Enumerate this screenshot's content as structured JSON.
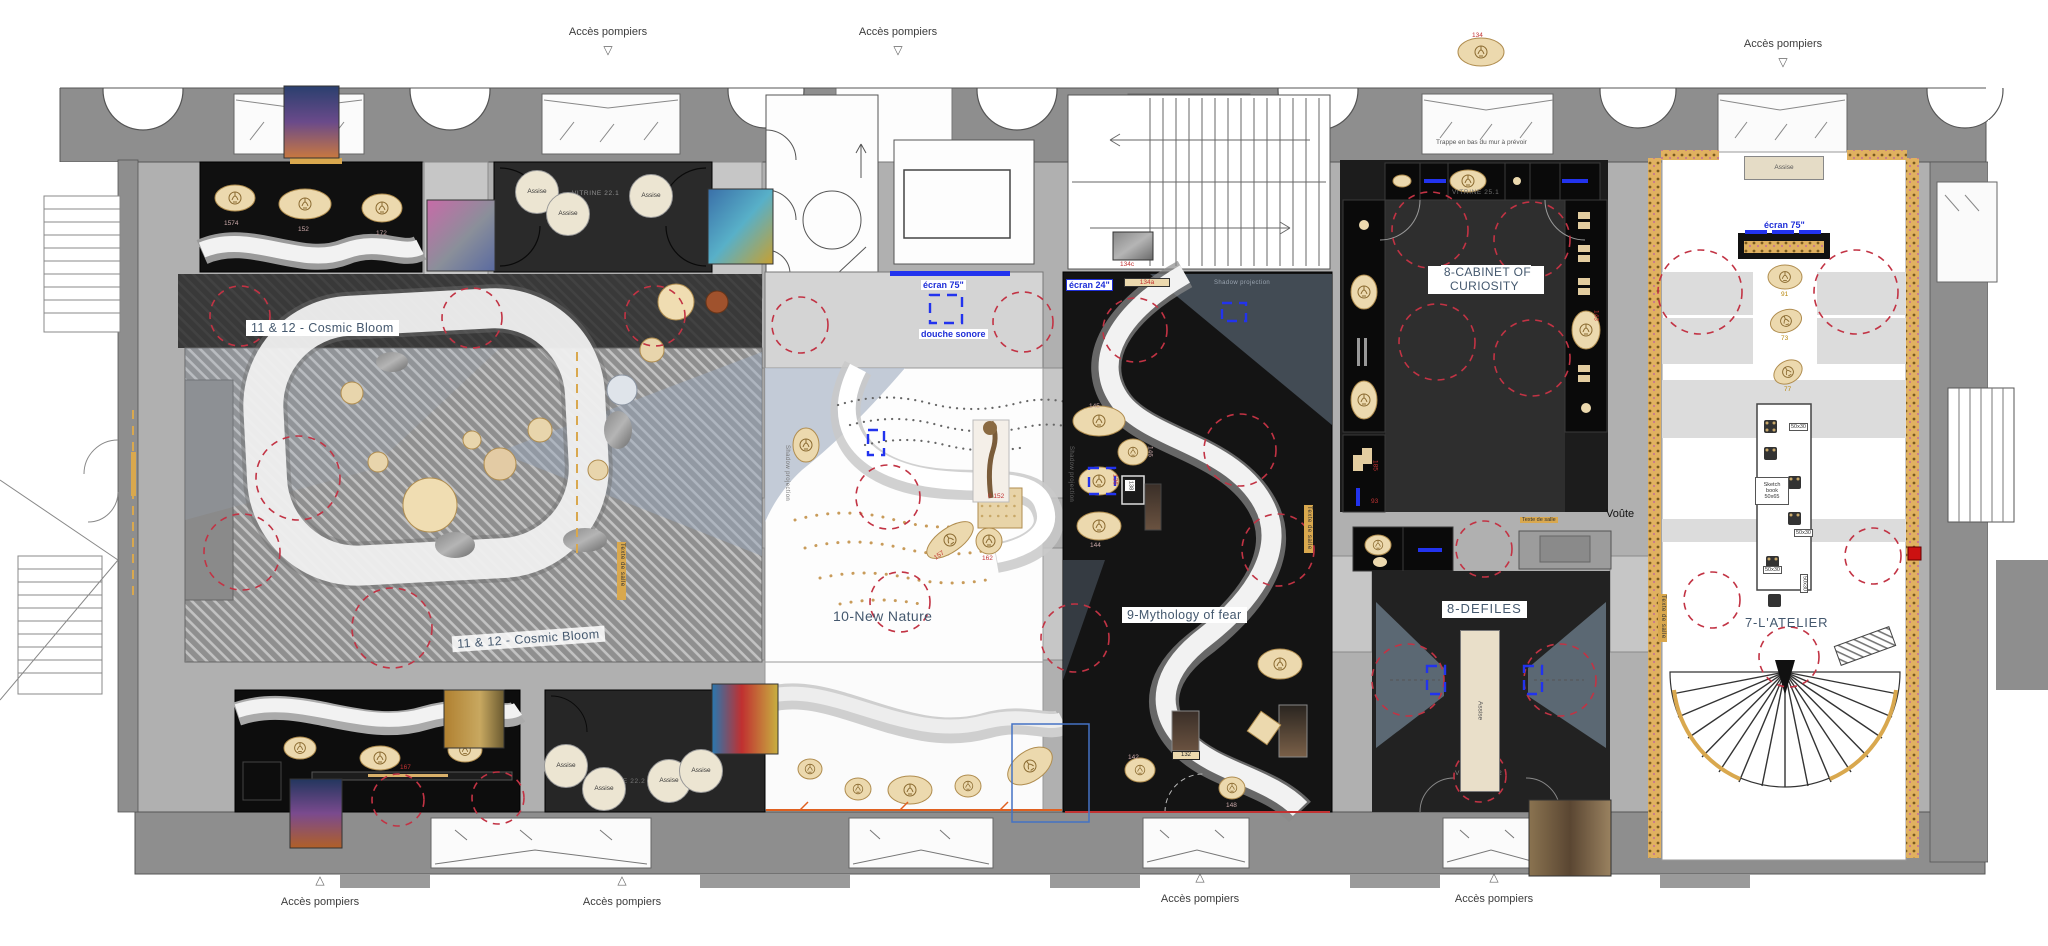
{
  "plan_title": "Museum exhibition floor plan",
  "strings": {
    "acces_pompiers": "Accès pompiers",
    "assise": "Assise",
    "ecran75": "écran 75\"",
    "ecran24": "écran 24\"",
    "douche_sonore": "douche sonore",
    "voute": "Voûte",
    "trappe": "Trappe en bas du mur à prévoir",
    "texte_de_salle": "Texte de salle",
    "shadow_projection": "Shadow projection",
    "sketch_book": "Sketch book\n50x65",
    "size_50x30": "50x30"
  },
  "rooms": {
    "cosmic_bloom_1": "11 & 12 - Cosmic Bloom",
    "cosmic_bloom_2": "11 & 12 - Cosmic Bloom",
    "new_nature": "10-New Nature",
    "mythology": "9-Mythology of fear",
    "cabinet": "8-CABINET OF\nCURIOSITY",
    "defiles": "8-DEFILES",
    "atelier": "7-L'ATELIER"
  },
  "vitrines": {
    "v221": "VITRINE 22.1",
    "v222": "VITRINE 22.2",
    "v251": "VITRINE 25.1",
    "v252": "VITRINE 25.2"
  },
  "annotations": {
    "n134": "134",
    "n134a": "134a",
    "n134c": "134c",
    "n0152": "0 152",
    "n157": "157",
    "n162": "162",
    "n145": "145",
    "n146": "146",
    "n136": "136",
    "n138": "138",
    "n144": "144",
    "n142": "142",
    "n148": "148",
    "n132": "132",
    "n167": "167",
    "n91": "91",
    "n73": "73",
    "n77": "77",
    "n143": "143",
    "n185": "185",
    "n93": "93",
    "n1574": "1574",
    "n152": "152",
    "n172": "172"
  },
  "icons": {
    "triangle_down": "▽",
    "triangle_up": "△"
  },
  "colors": {
    "wall_gray": "#8e8e8e",
    "corridor_gray": "#b0b0b0",
    "room_black": "#141414",
    "room_dark": "#2a2a2a",
    "beige": "#ecd9ae",
    "gold": "#d9a84e",
    "dashed_red": "#c23344",
    "projector_blue": "#1f2fd8",
    "label_slate": "#44586e",
    "accent_red_square": "#cc1111",
    "accent_orange": "#e06020"
  }
}
